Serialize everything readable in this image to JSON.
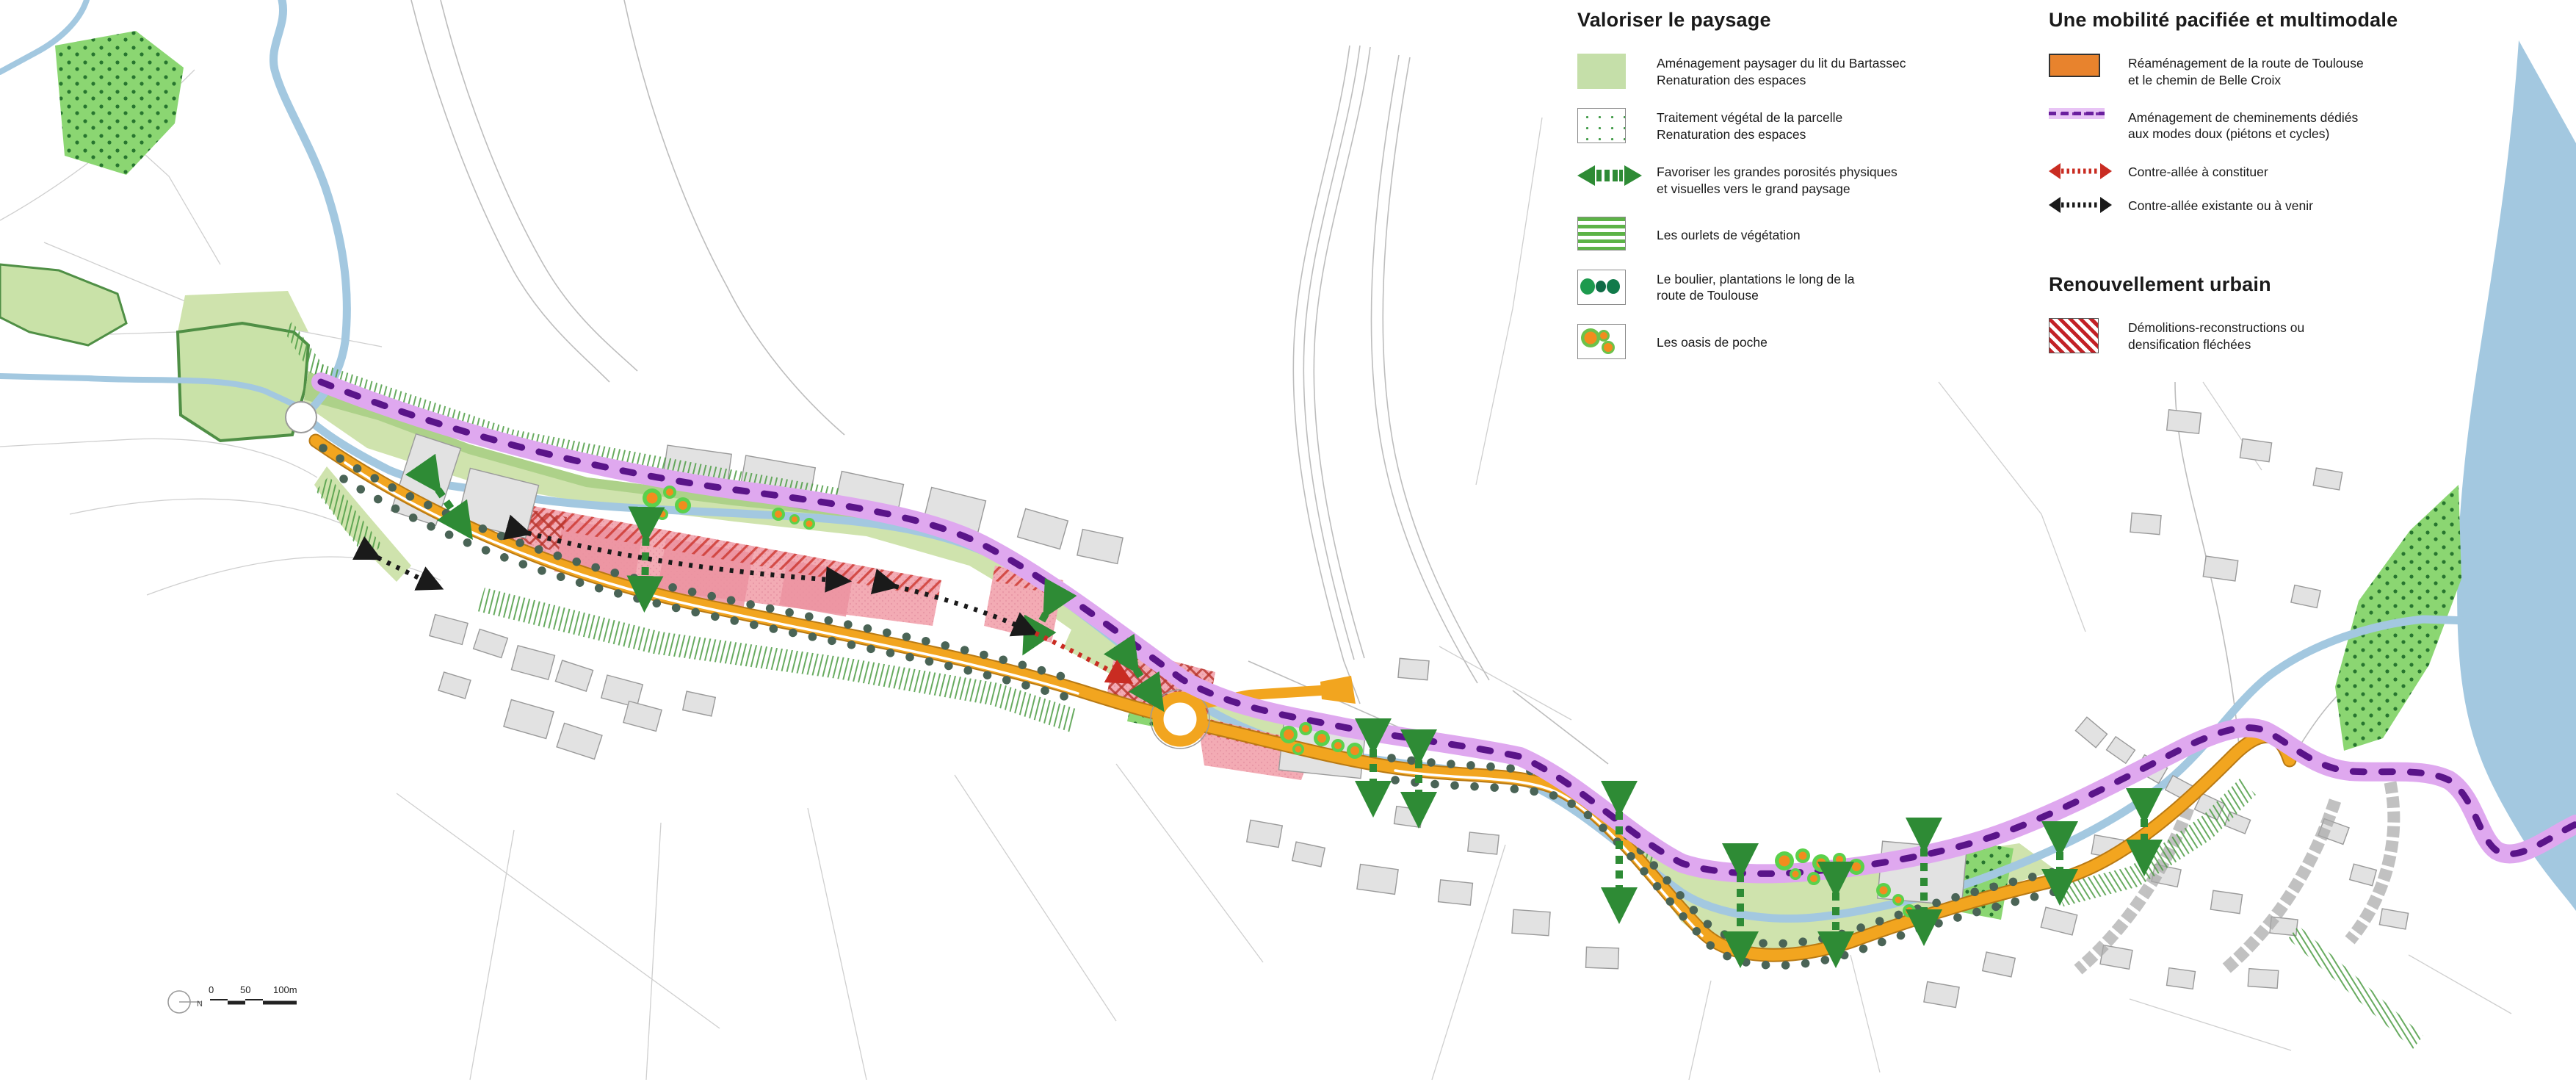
{
  "legend": {
    "paysage": {
      "title": "Valoriser le paysage",
      "items": [
        {
          "id": "amenagement-bartassec",
          "lines": [
            "Aménagement paysager du lit du Bartassec",
            "Renaturation des espaces"
          ]
        },
        {
          "id": "traitement-vegetal",
          "lines": [
            "Traitement végétal de la parcelle",
            "Renaturation des espaces"
          ]
        },
        {
          "id": "porosites",
          "lines": [
            "Favoriser les grandes porosités physiques",
            "et visuelles vers le grand paysage"
          ]
        },
        {
          "id": "ourlets",
          "lines": [
            "Les ourlets de végétation",
            ""
          ]
        },
        {
          "id": "boulier",
          "lines": [
            "Le boulier, plantations le long de la",
            "route de Toulouse"
          ]
        },
        {
          "id": "oasis",
          "lines": [
            "Les oasis de poche",
            ""
          ]
        }
      ]
    },
    "mobilite": {
      "title": "Une mobilité pacifiée et multimodale",
      "items": [
        {
          "id": "route-toulouse",
          "lines": [
            "Réaménagement de la route de Toulouse",
            "et le chemin de Belle Croix"
          ]
        },
        {
          "id": "modes-doux",
          "lines": [
            "Aménagement de cheminements dédiés",
            "aux modes doux (piétons et cycles)"
          ]
        },
        {
          "id": "contre-allee-constituer",
          "lines": [
            "Contre-allée à constituer",
            ""
          ]
        },
        {
          "id": "contre-allee-existante",
          "lines": [
            "Contre-allée existante ou à venir",
            ""
          ]
        }
      ]
    },
    "renouvellement": {
      "title": "Renouvellement urbain",
      "items": [
        {
          "id": "demolitions",
          "lines": [
            "Démolitions-reconstructions ou",
            "densification fléchées"
          ]
        }
      ]
    }
  },
  "scalebar": {
    "labels": [
      "0",
      "50",
      "100m"
    ],
    "north_letter": "N"
  },
  "colors": {
    "road_orange": "#f2a51f",
    "legend_orange": "#e8832d",
    "modes_doux_band": "#dfa8ef",
    "modes_doux_dash": "#5a1489",
    "light_green": "#cfe3ad",
    "legend_green": "#c5dfa9",
    "medium_green": "#a8ce85",
    "dotted_green_fill": "#8bd672",
    "dotted_green_dot": "#27752f",
    "stripe_green": "#5cb347",
    "porosity_arrow_green": "#2e8b35",
    "oasis_orange": "#f28c1e",
    "oasis_halo_green": "#5bd14c",
    "tree_dot": "#4a6456",
    "demolition_pink": "#f3abb4",
    "demolition_red": "#c92c22",
    "water_blue": "#a3c8e0",
    "building_gray": "#e2e2e2",
    "parcel_gray": "#c9c9c9"
  }
}
